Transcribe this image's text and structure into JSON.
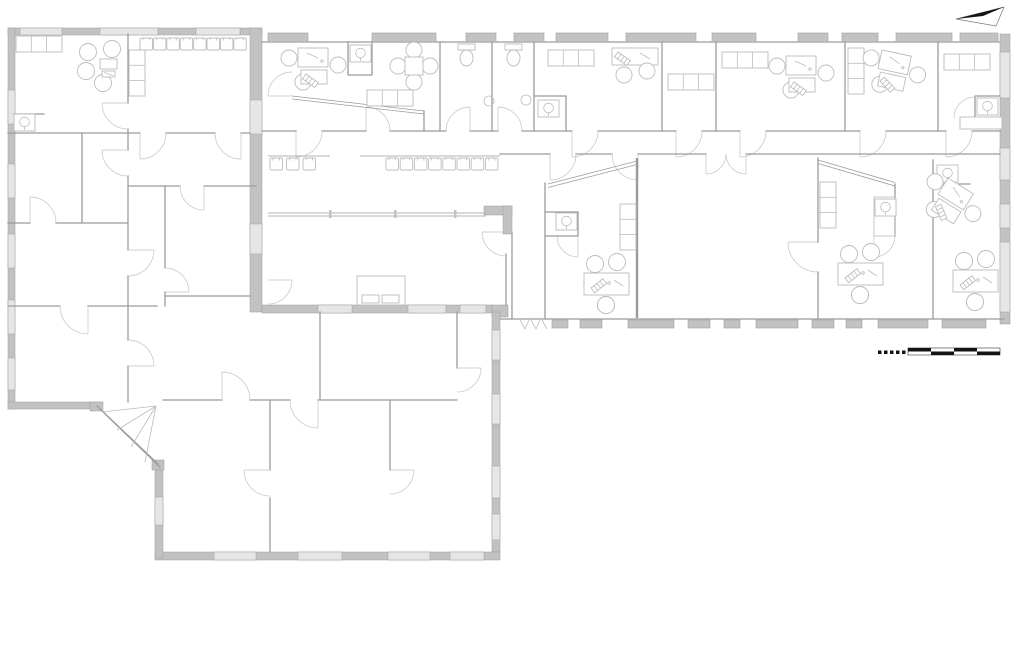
{
  "canvas": {
    "width": 1024,
    "height": 663
  },
  "colors": {
    "bg": "#ffffff",
    "wall_fill": "#c2c2c2",
    "wall_window": "#e6e6e6",
    "wall_line": "#9e9e9e",
    "line": "#9b9b9b",
    "furn": "#bcbcbc",
    "door": "#c3c3c3",
    "black": "#141414"
  },
  "legend_symbols": [
    "north-arrow-icon",
    "scale-bar",
    "window",
    "door-swing",
    "desk",
    "office-chair",
    "meeting-table",
    "round-table",
    "lounge-seating",
    "waiting-chair",
    "sofa",
    "cabinet",
    "wardrobe",
    "toilet",
    "sink",
    "bed"
  ],
  "north_arrow": {
    "direction": "right",
    "black_points": "956,19 1004,7 983,16",
    "white_points": "956,19 1004,7 996,26"
  },
  "scale_bar": {
    "x": 908,
    "y": 348,
    "seg_w": 23,
    "seg_h": 3.5,
    "segments": 4,
    "dash_x": 878,
    "dash_y": 350.5,
    "dash_count": 5,
    "dash_step": 6,
    "dash_size": 3.5
  },
  "windows": {
    "wing_top": [
      [
        268,
        40
      ],
      [
        372,
        64
      ],
      [
        466,
        30
      ],
      [
        514,
        30
      ],
      [
        556,
        52
      ],
      [
        626,
        70
      ],
      [
        712,
        44
      ],
      [
        798,
        30
      ],
      [
        842,
        36
      ],
      [
        896,
        56
      ],
      [
        960,
        38
      ]
    ],
    "wing_bottom": [
      [
        552,
        16
      ],
      [
        580,
        22
      ],
      [
        628,
        46
      ],
      [
        688,
        22
      ],
      [
        724,
        16
      ],
      [
        756,
        42
      ],
      [
        812,
        22
      ],
      [
        846,
        16
      ],
      [
        878,
        50
      ],
      [
        942,
        44
      ]
    ],
    "wing_right": [
      [
        52,
        46
      ],
      [
        148,
        32
      ],
      [
        204,
        24
      ],
      [
        242,
        70
      ]
    ],
    "a_top": [
      [
        20,
        42
      ],
      [
        100,
        58
      ],
      [
        196,
        44
      ]
    ],
    "a_left": [
      [
        90,
        34
      ],
      [
        164,
        34
      ],
      [
        234,
        34
      ],
      [
        300,
        34
      ],
      [
        358,
        32
      ]
    ],
    "a_right": [
      [
        100,
        34
      ],
      [
        224,
        30
      ]
    ],
    "b_top": [
      [
        318,
        34
      ],
      [
        408,
        38
      ],
      [
        460,
        26
      ]
    ],
    "b_right": [
      [
        330,
        30
      ],
      [
        394,
        30
      ],
      [
        466,
        32
      ],
      [
        514,
        26
      ]
    ],
    "b_bottom": [
      [
        214,
        42
      ],
      [
        298,
        44
      ],
      [
        388,
        42
      ],
      [
        450,
        34
      ]
    ],
    "b_left": [
      [
        497,
        28
      ]
    ]
  },
  "seating": {
    "row_corridor_left": {
      "x": 270,
      "y": 158,
      "count": 3,
      "step": 16.5
    },
    "row_corridor_right": {
      "x": 386,
      "y": 158,
      "count": 8,
      "step": 14.2
    },
    "row_room_topleft": {
      "x": 140,
      "y": 38,
      "count": 8,
      "step": 13.4
    }
  }
}
